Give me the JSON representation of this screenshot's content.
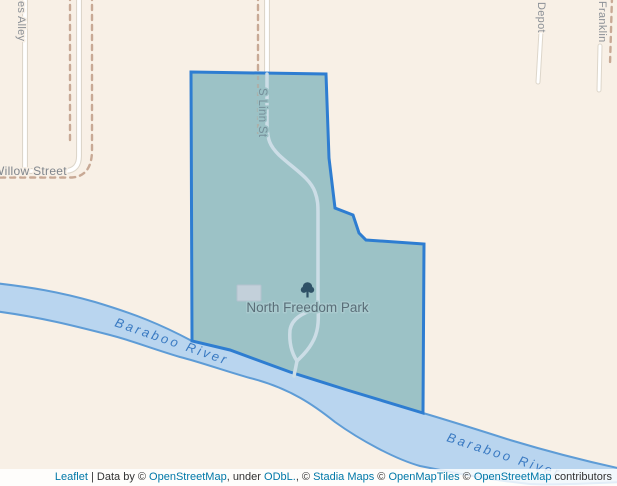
{
  "map": {
    "park": {
      "name": "North Freedom Park",
      "highlight_fill": "#9cc2c6",
      "highlight_border": "#2e7dd1",
      "label_color": "#5a6e78"
    },
    "river": {
      "name": "Baraboo River",
      "fill": "#b9d5ef",
      "bank_color": "#5e9cd6",
      "label_color": "#3a7ac2"
    },
    "streets": {
      "alley_label": "es Alley",
      "willow_label": "Willow Street",
      "linn_label": "S Linn St",
      "depot_label": "Depot",
      "franklin_label": "Franklin"
    },
    "background_color": "#f8f0e6",
    "street_label_color": "#8b9096"
  },
  "attribution": {
    "leaflet_label": "Leaflet",
    "separator": " | ",
    "data_by": "Data by © ",
    "osm_link_1": "OpenStreetMap",
    "under_text": ", under ",
    "odbl_link": "ODbL.",
    "stadia_prefix": ", © ",
    "stadia_link": "Stadia Maps",
    "omt_prefix": " © ",
    "omt_link": "OpenMapTiles",
    "osm2_prefix": " © ",
    "osm_link_2": "OpenStreetMap",
    "contributors_text": " contributors",
    "link_color": "#0078a8",
    "bg": "rgba(255,255,255,0.82)"
  }
}
